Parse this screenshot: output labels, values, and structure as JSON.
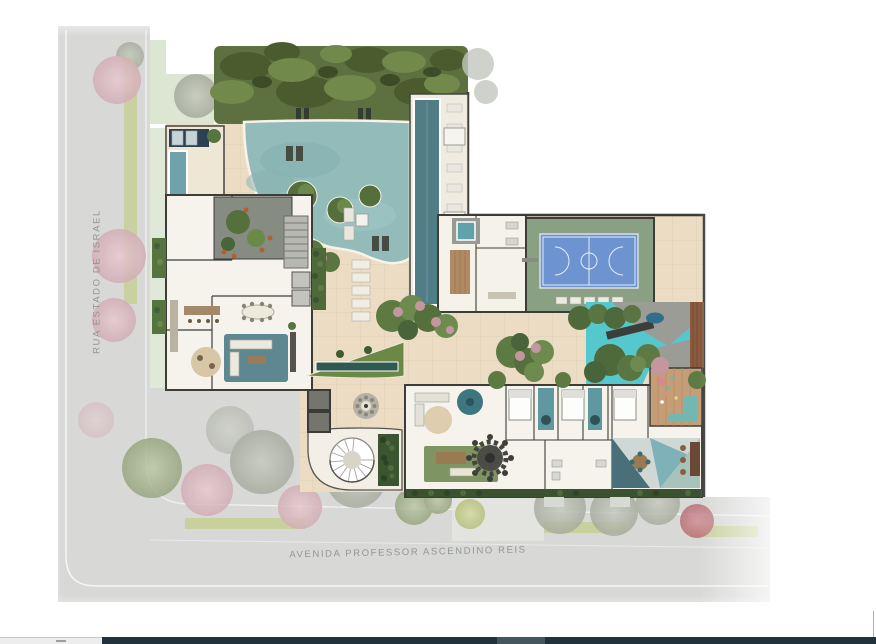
{
  "meta": {
    "kind": "illustrated architectural site plan (top-down masterplan rendering)",
    "orientation": "streets on west and south edges, amenity deck and buildings inside"
  },
  "streets": {
    "left": {
      "name": "RUA ESTADO DE ISRAEL",
      "orientation": "vertical along left edge"
    },
    "bottom": {
      "name": "AVENIDA PROFESSOR ASCENDINO REIS",
      "orientation": "horizontal along bottom edge"
    }
  },
  "plan_features": [
    {
      "id": "tree-canopy",
      "label": "Dense tree canopy along north edge"
    },
    {
      "id": "main-pool",
      "label": "Organic leisure pool with planted islands and in-water loungers"
    },
    {
      "id": "lap-pool",
      "label": "Long lap pool with lounger row"
    },
    {
      "id": "plunge-pool",
      "label": "Small plunge pool with sun mat deck (northwest corner)"
    },
    {
      "id": "sports-court",
      "label": "Blue multi-sport court on green surround"
    },
    {
      "id": "splash-pad",
      "label": "Cyan kids splash pad with water sculpture and timber deck"
    },
    {
      "id": "indoor-lounge-wing",
      "label": "West wing: kitchen/bar, dining, lounge with teal rugs"
    },
    {
      "id": "winter-garden-patio",
      "label": "Internal landscaped patio with trees and rust chairs"
    },
    {
      "id": "stairs-elevators",
      "label": "Core with staircase and elevators"
    },
    {
      "id": "changing-rooms",
      "label": "Changing rooms / sauna block with spa plunge"
    },
    {
      "id": "suites",
      "label": "South band: suites with beds and teal bath floors"
    },
    {
      "id": "living-lounge",
      "label": "South band: living lounge with round games table"
    },
    {
      "id": "kids-playroom",
      "label": "Kids playroom with timber floor and teal sofa"
    },
    {
      "id": "coworking-lounge",
      "label": "Coworking lounge with geometric rug and desks"
    },
    {
      "id": "spiral-staircase",
      "label": "External spiral staircase on curved terrace"
    },
    {
      "id": "mosaic-medallion",
      "label": "Round mosaic medallion on deck"
    },
    {
      "id": "garden-islands",
      "label": "Planted deck islands with pink flowering shrubs"
    },
    {
      "id": "reflecting-channel",
      "label": "Linear water channel in triangular lawn island"
    },
    {
      "id": "street-trees",
      "label": "Muted pink / green / gray street trees and flower strips"
    },
    {
      "id": "plaza-sidewalk",
      "label": "Gray concrete plaza at southwest corner"
    },
    {
      "id": "entry-walkway",
      "label": "Pedestrian crossing walkway to avenue"
    }
  ],
  "colors": {
    "deck_beige": "#ebdcc3",
    "pool_water": "#92bbb9",
    "lap_pool_water": "#517d86",
    "splash_water": "#55c8cd",
    "court_blue": "#6d94d1",
    "court_green": "#8aa083",
    "canopy_green": "#5c7040",
    "lawn_green": "#6b8847",
    "hedge_green": "#3c5531",
    "street_gray": "#d8d9d7",
    "wall_dark": "#3d3d38",
    "wood": "#b08a63",
    "teal_rug": "#54828c",
    "pink_tree": "#dcb9c1",
    "street_label_gray": "#8f9394"
  },
  "window_edge_bar": {
    "description": "sliver of another window visible at very bottom edge",
    "left_segment_color": "#ededed",
    "main_segment_color": "#22323d",
    "accent_segment_color": "#46565f"
  }
}
